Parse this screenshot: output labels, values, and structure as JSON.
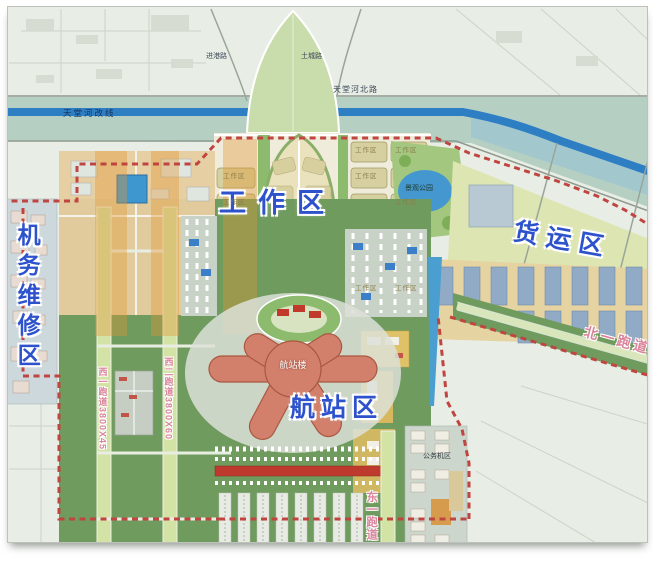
{
  "labels": {
    "work_zone": "工作区",
    "cargo_zone": "货运区",
    "terminal_zone": "航站区",
    "maintenance_zone": "机务维修区",
    "terminal_building": "航站楼",
    "business_jet_area": "公务机区",
    "landscape_park": "景观公园",
    "work_block": "工作区"
  },
  "runways": {
    "west1": "西一跑道3800X45",
    "west2": "西二跑道3800X60",
    "north1": "北一跑道",
    "east1": "东一跑道"
  },
  "roads": {
    "tiantang_north": "天堂河北路",
    "jin_gang": "进港路",
    "tucheng": "土城路"
  },
  "water": {
    "river": "天堂河改线"
  },
  "colors": {
    "zone_label_blue": "#2d52cc",
    "runway_label_pink": "#d9849b",
    "boundary_red": "#c04540",
    "airfield_green": "#6f9b5e",
    "river_blue": "#2e7ec4",
    "terminal_salmon": "#d2806b",
    "block_tan": "#d6cf9f",
    "cargo_field": "#dde5b2",
    "warehouse_blue": "#91abc6"
  }
}
